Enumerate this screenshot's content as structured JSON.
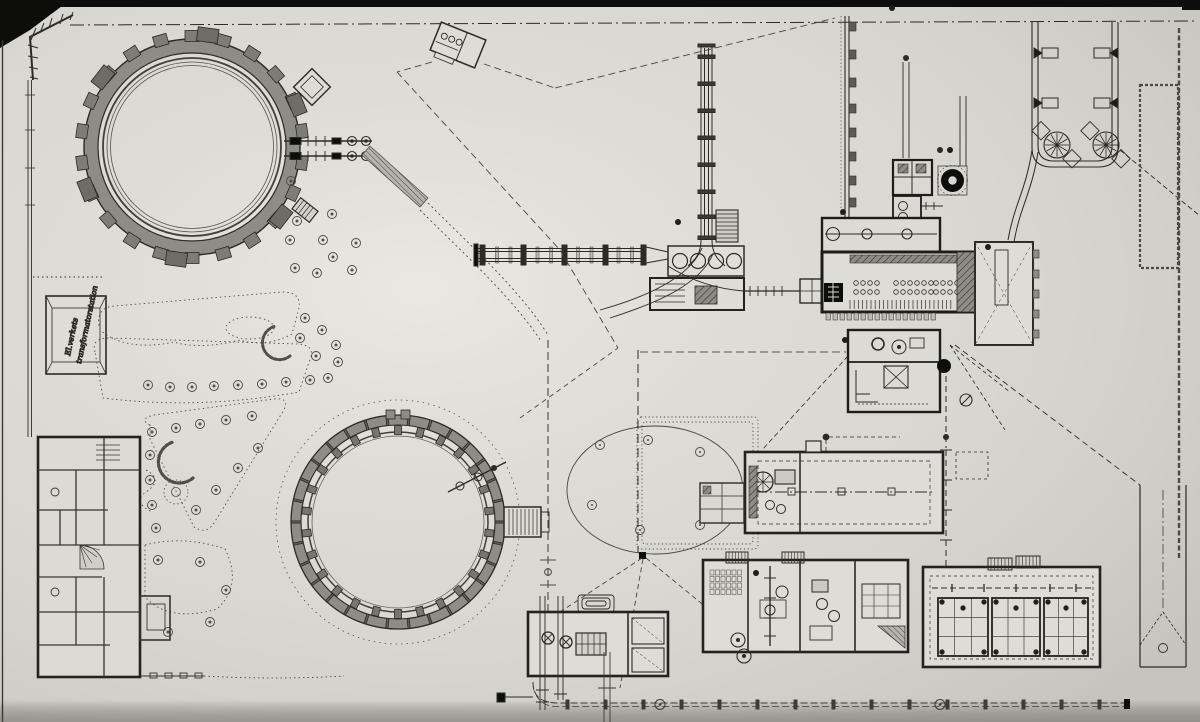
{
  "document": {
    "kind": "scanned gasworks site plan drawing",
    "visible_text_note": "single handwritten annotation on a small hip-roofed building at left edge"
  },
  "annotations": {
    "transformer_station": {
      "line1": "El.verkets",
      "line2": "transformatorstation"
    }
  },
  "palette": {
    "paper": "#d8d6d0",
    "paper_light": "#e4e2dc",
    "ink": "#2b2a27",
    "ink_soft": "#55524c",
    "wall": "#1d1c1a",
    "band": "#8e8c86",
    "band2": "#a09e98",
    "metal": "#6a6863",
    "black": "#0d0d0c"
  }
}
